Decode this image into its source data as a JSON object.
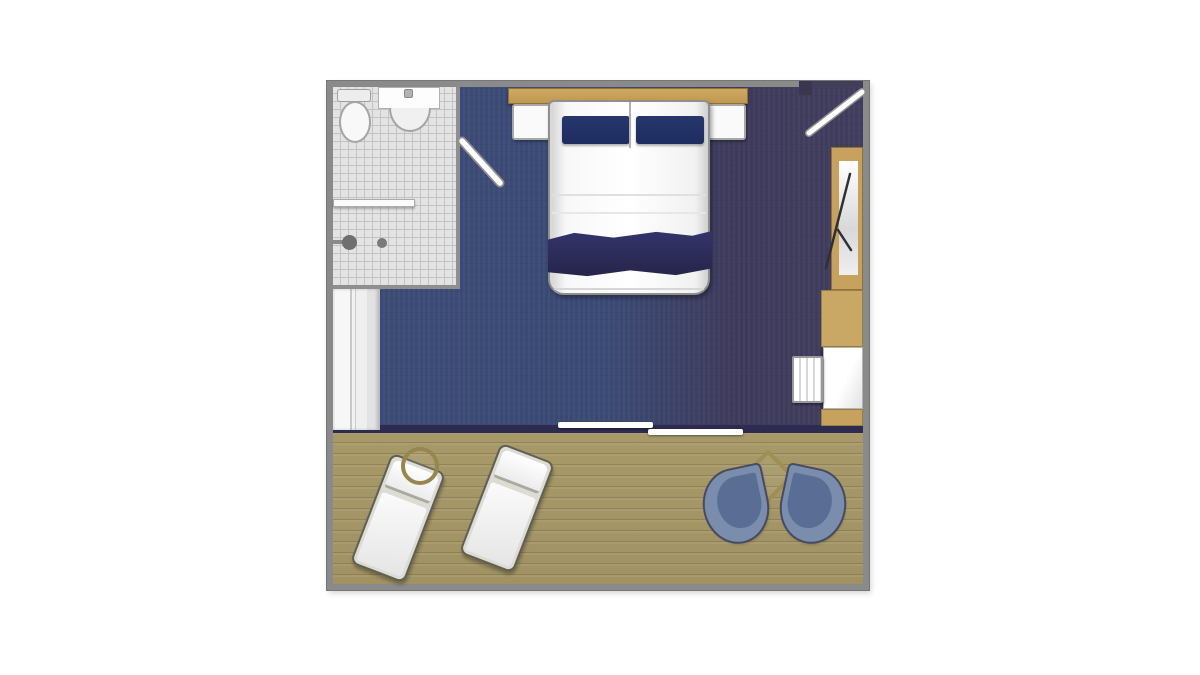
{
  "colors": {
    "page-bg": "#ffffff",
    "outer-wall": "#8a8a8a",
    "tile-floor": "#e3e3e3",
    "tile-grid": "#c3c3c3",
    "carpet-blue": "#3c4b76",
    "carpet-dark": "#3e3a5b",
    "interior-wall": "#2e2b50",
    "wood-tan": "#c7a25e",
    "wood-tan-dark": "#8f7336",
    "deck-wood": "#a79968",
    "pillow-navy": "#1e2c5f",
    "blanket-navy": "#2c2b5a",
    "furniture-outline": "#8f8f8f",
    "chair-blue": "#7a8dac",
    "chair-blue-dark": "#5a6d94",
    "chair-outline": "#454b60",
    "table-outline": "#97864f",
    "shower-gray": "#6f6f6f"
  },
  "floorplan": {
    "kind": "cabin floor plan, top view, no text labels",
    "rooms": {
      "bathroom": {
        "name": "bathroom",
        "features": [
          "toilet",
          "sink with basin",
          "towel bar",
          "shower controls",
          "tiled floor",
          "white door swing into bedroom"
        ]
      },
      "bedroom": {
        "name": "bedroom",
        "features": [
          "double bed with two navy pillows and navy blanket band",
          "tan headboard",
          "two white nightstands",
          "white sofa strip on left wall",
          "tan wardrobe with bifold door",
          "tan cabinet",
          "white desk with striped stool",
          "entry door swing top-right",
          "sliding glass door to balcony",
          "navy carpet fading to dark plum on right"
        ]
      },
      "balcony": {
        "name": "balcony",
        "features": [
          "wood plank deck",
          "two white sun loungers",
          "round side table",
          "diamond table",
          "two slate-blue shell chairs"
        ]
      }
    }
  }
}
